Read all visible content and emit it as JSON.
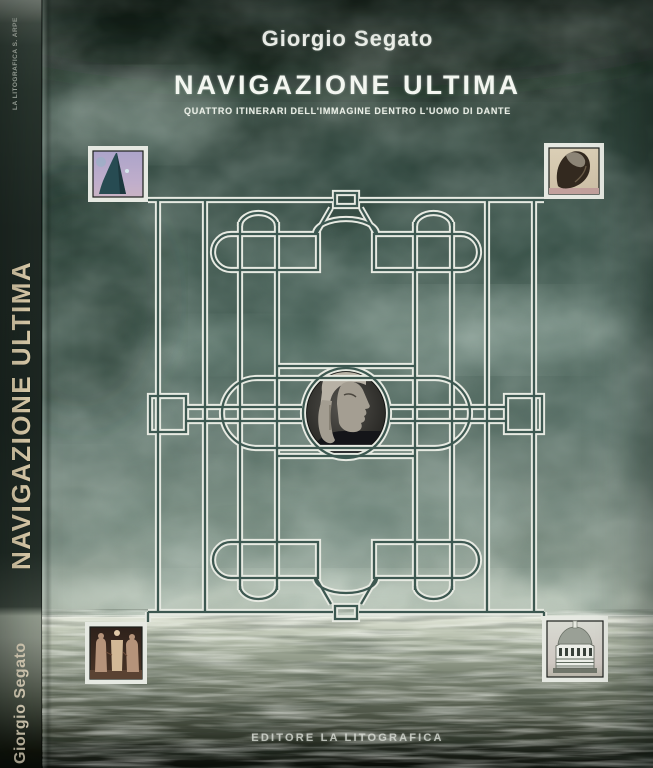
{
  "cover": {
    "author": "Giorgio Segato",
    "title": "NAVIGAZIONE ULTIMA",
    "subtitle": "QUATTRO ITINERARI DELL'IMMAGINE DENTRO L'UOMO DI DANTE",
    "publisher_line": "EDITORE LA LITOGRAFICA"
  },
  "spine": {
    "top_imprint": "LA LITOGRAFICA S. ARPE",
    "title": "NAVIGAZIONE ULTIMA",
    "author": "Giorgio Segato"
  },
  "artwork": {
    "scene": "stormy teal sky over a silver sea with horizon",
    "ornament": "interlaced double-line silver frame with corner knots, side squares, central capsule and oval medallion",
    "center_medallion": "profile portrait of Dante with hood and laurel wreath",
    "corner_images": [
      {
        "position": "top-left",
        "subject": "hooded dark figure on lavender background"
      },
      {
        "position": "top-right",
        "subject": "crouching figure on cream background"
      },
      {
        "position": "bottom-left",
        "subject": "three robed sculpted figures on dark sepia"
      },
      {
        "position": "bottom-right",
        "subject": "Florence Baptistery building on pale background"
      }
    ]
  },
  "colors": {
    "sky_dark": "#1a2620",
    "sky_teal": "#4b635a",
    "cloud_light": "#c2d6cb",
    "sea_light": "#e0e4d6",
    "sea_dark": "#0b0d08",
    "ornament_line": "#e7eae2",
    "spine_text": "#e9d8b4",
    "cover_text": "#f3f6f0"
  }
}
